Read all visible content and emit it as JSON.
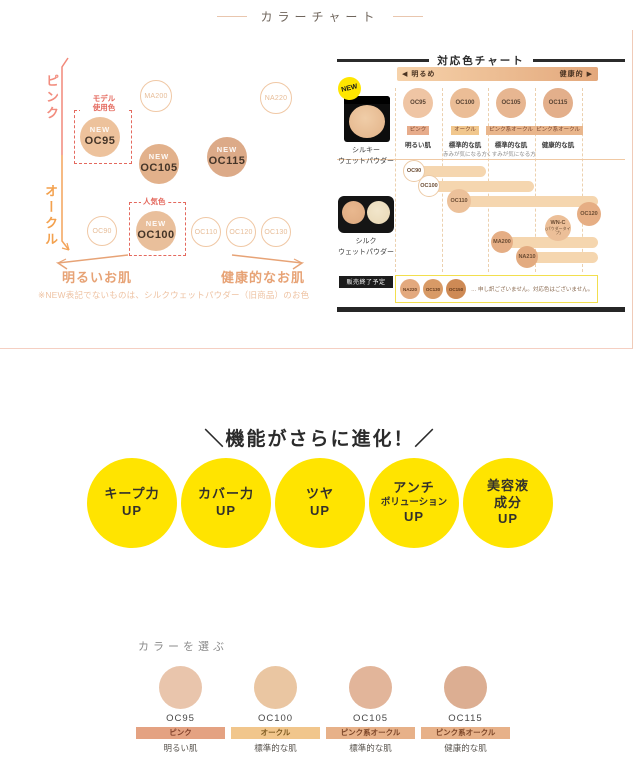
{
  "header": {
    "title": "カラーチャート"
  },
  "left_chart": {
    "y_axis_top": "ピンク",
    "y_axis_bottom": "オークル",
    "x_axis_left": "明るいお肌",
    "x_axis_right": "健康的なお肌",
    "model_label_line1": "モデル",
    "model_label_line2": "使用色",
    "popular_label": "人気色",
    "new_text": "NEW",
    "footnote": "※NEW表記でないものは、シルクウェットパウダー（旧商品）のお色",
    "circles": [
      {
        "shade": "MA200",
        "style": "outline",
        "new": false,
        "x": 156,
        "y": 96,
        "r": 16
      },
      {
        "shade": "NA220",
        "style": "outline",
        "new": false,
        "x": 276,
        "y": 98,
        "r": 16
      },
      {
        "shade": "OC95",
        "style": "filled",
        "new": true,
        "x": 100,
        "y": 137,
        "r": 20,
        "color": "#edc29c"
      },
      {
        "shade": "OC105",
        "style": "filled",
        "new": true,
        "x": 159,
        "y": 164,
        "r": 20,
        "color": "#e2b18b"
      },
      {
        "shade": "OC115",
        "style": "filled",
        "new": true,
        "x": 227,
        "y": 157,
        "r": 20,
        "color": "#dcaa88"
      },
      {
        "shade": "OC90",
        "style": "outline",
        "new": false,
        "x": 102,
        "y": 231,
        "r": 15
      },
      {
        "shade": "OC100",
        "style": "filled",
        "new": true,
        "x": 156,
        "y": 231,
        "r": 20,
        "color": "#e9bf9b"
      },
      {
        "shade": "OC110",
        "style": "outline",
        "new": false,
        "x": 206,
        "y": 232,
        "r": 15
      },
      {
        "shade": "OC120",
        "style": "outline",
        "new": false,
        "x": 241,
        "y": 232,
        "r": 15
      },
      {
        "shade": "OC130",
        "style": "outline",
        "new": false,
        "x": 276,
        "y": 232,
        "r": 15
      }
    ]
  },
  "right_chart": {
    "title": "対応色チャート",
    "scale_left": "◀ 明るめ",
    "scale_right": "健康的 ▶",
    "new_badge": "NEW",
    "product_new": {
      "name_line1": "シルキー",
      "name_line2": "ウェットパウダー"
    },
    "product_old": {
      "name_line1": "シルク",
      "name_line2": "ウェットパウダー",
      "badge": "販売終了予定"
    },
    "columns": [
      {
        "shade": "OC95",
        "tone": "ピンク",
        "tone_bg": "#e7ac8b",
        "skin": "明るい肌",
        "note": "",
        "color": "#efc5a4"
      },
      {
        "shade": "OC100",
        "tone": "オークル",
        "tone_bg": "#f1c78d",
        "skin": "標準的な肌",
        "note": "赤みが気になる方",
        "color": "#ebbd96"
      },
      {
        "shade": "OC105",
        "tone": "ピンク系オークル",
        "tone_bg": "#e9b68c",
        "skin": "標準的な肌",
        "note": "くすみが気になる方",
        "color": "#e7b691"
      },
      {
        "shade": "OC115",
        "tone": "ピンク系オークル",
        "tone_bg": "#e9b68c",
        "skin": "健康的な肌",
        "note": "",
        "color": "#e3af8b"
      }
    ],
    "rows": [
      {
        "shade": "OC90",
        "style": "outline",
        "x": 414,
        "y": 171,
        "r": 11,
        "bar_to": 486
      },
      {
        "shade": "OC100",
        "style": "outline",
        "x": 429,
        "y": 186,
        "r": 11,
        "bar_to": 534
      },
      {
        "shade": "OC110",
        "style": "filled",
        "color": "#ecc19a",
        "x": 459,
        "y": 201,
        "r": 12,
        "bar_to": 598
      },
      {
        "shade": "OC120",
        "style": "filled",
        "color": "#e6ae84",
        "x": 589,
        "y": 214,
        "r": 12,
        "bar_to": 0
      },
      {
        "shade": "WN-C",
        "sub": "(パウダータイプ)",
        "style": "filled",
        "color": "#ecbf98",
        "x": 558,
        "y": 228,
        "r": 13,
        "bar_to": 0
      },
      {
        "shade": "MA200",
        "style": "filled",
        "color": "#e5ae85",
        "x": 502,
        "y": 242,
        "r": 11,
        "bar_to": 598
      },
      {
        "shade": "NA210",
        "style": "filled",
        "color": "#e3ab80",
        "x": 527,
        "y": 257,
        "r": 11,
        "bar_to": 598
      }
    ],
    "no_match": {
      "shades": [
        {
          "shade": "NA220",
          "color": "#e3a97e"
        },
        {
          "shade": "OC130",
          "color": "#d89a66"
        },
        {
          "shade": "OC150",
          "color": "#ce8a55"
        }
      ],
      "text": "… 申し訳ございません。対応色はございません。"
    }
  },
  "features": {
    "heading": "＼機能がさらに進化！／",
    "circle_color": "#ffe400",
    "items": [
      {
        "lines": [
          "キープ力",
          "UP"
        ],
        "small_line": -1
      },
      {
        "lines": [
          "カバー力",
          "UP"
        ],
        "small_line": -1
      },
      {
        "lines": [
          "ツヤ",
          "UP"
        ],
        "small_line": -1
      },
      {
        "lines": [
          "アンチ",
          "ポリューション",
          "UP"
        ],
        "small_line": 1
      },
      {
        "lines": [
          "美容液",
          "成分",
          "UP"
        ],
        "small_line": -1
      }
    ]
  },
  "color_picker": {
    "heading": "カラーを選ぶ",
    "swatches": [
      {
        "shade": "OC95",
        "color": "#e9c5ac",
        "tone": "ピンク",
        "tone_bg": "#e4a282",
        "tone_color": "#83422c",
        "skin": "明るい肌"
      },
      {
        "shade": "OC100",
        "color": "#eac6a2",
        "tone": "オークル",
        "tone_bg": "#f1c68c",
        "tone_color": "#7d5a20",
        "skin": "標準的な肌"
      },
      {
        "shade": "OC105",
        "color": "#e2b59a",
        "tone": "ピンク系オークル",
        "tone_bg": "#e7b189",
        "tone_color": "#7c4527",
        "skin": "標準的な肌"
      },
      {
        "shade": "OC115",
        "color": "#dcae92",
        "tone": "ピンク系オークル",
        "tone_bg": "#e7b189",
        "tone_color": "#7c4527",
        "skin": "健康的な肌"
      }
    ]
  }
}
